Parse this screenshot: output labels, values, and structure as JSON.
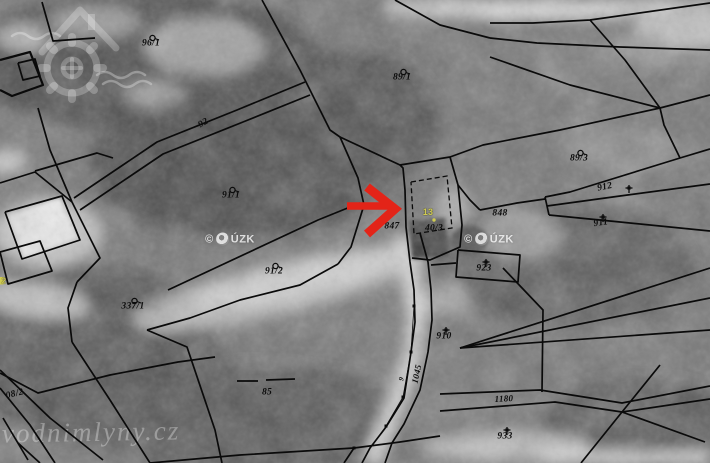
{
  "map": {
    "labels": [
      {
        "text": "96/1",
        "x": 151,
        "y": 44,
        "sym": "circle"
      },
      {
        "text": "89/1",
        "x": 402,
        "y": 78,
        "sym": "circle"
      },
      {
        "text": "92",
        "x": 204,
        "y": 124,
        "rot": -31
      },
      {
        "text": "89/3",
        "x": 579,
        "y": 159,
        "sym": "circle"
      },
      {
        "text": "912",
        "x": 605,
        "y": 188,
        "rot": -12,
        "sym": "cross",
        "symDx": 19,
        "symDy": -4
      },
      {
        "text": "911",
        "x": 601,
        "y": 224,
        "rot": -8,
        "sym": "cross"
      },
      {
        "text": "91/1",
        "x": 231,
        "y": 196,
        "sym": "circle"
      },
      {
        "text": "847",
        "x": 392,
        "y": 227
      },
      {
        "text": "13",
        "x": 428,
        "y": 212,
        "highlight": true
      },
      {
        "text": "40/3",
        "x": 434,
        "y": 229
      },
      {
        "text": "848",
        "x": 500,
        "y": 214
      },
      {
        "text": "923",
        "x": 484,
        "y": 269,
        "sym": "cross"
      },
      {
        "text": "91/2",
        "x": 274,
        "y": 272,
        "sym": "circle"
      },
      {
        "text": "337/1",
        "x": 133,
        "y": 307,
        "sym": "circle"
      },
      {
        "text": "910",
        "x": 444,
        "y": 337,
        "sym": "cross"
      },
      {
        "text": "85",
        "x": 267,
        "y": 393
      },
      {
        "text": "1045",
        "x": 417,
        "y": 374,
        "rot": -78,
        "size": 9
      },
      {
        "text": "9",
        "x": 402,
        "y": 379,
        "rot": -75,
        "size": 7
      },
      {
        "text": "1180",
        "x": 504,
        "y": 399,
        "rot": -3,
        "size": 9
      },
      {
        "text": "933",
        "x": 505,
        "y": 437,
        "sym": "cross"
      },
      {
        "text": "08/2",
        "x": 15,
        "y": 395,
        "rot": -14
      },
      {
        "text": "2",
        "x": 4,
        "y": 281,
        "highlight": true,
        "size": 8
      }
    ]
  },
  "watermarks": {
    "cuzk": {
      "text_prefix": "©",
      "text_suffix": "ÚZK",
      "positions": [
        {
          "x": 230,
          "y": 239
        },
        {
          "x": 489,
          "y": 239
        }
      ]
    },
    "site": {
      "text": "vodnimlyny.cz"
    }
  },
  "annotations": {
    "arrow_color": "#e32418",
    "arrow_direction": "right",
    "highlight_color": "#cfcb52"
  },
  "colors": {
    "boundary_line": "#0a0a0a",
    "watermark_text": "rgba(255,255,255,0.78)"
  }
}
